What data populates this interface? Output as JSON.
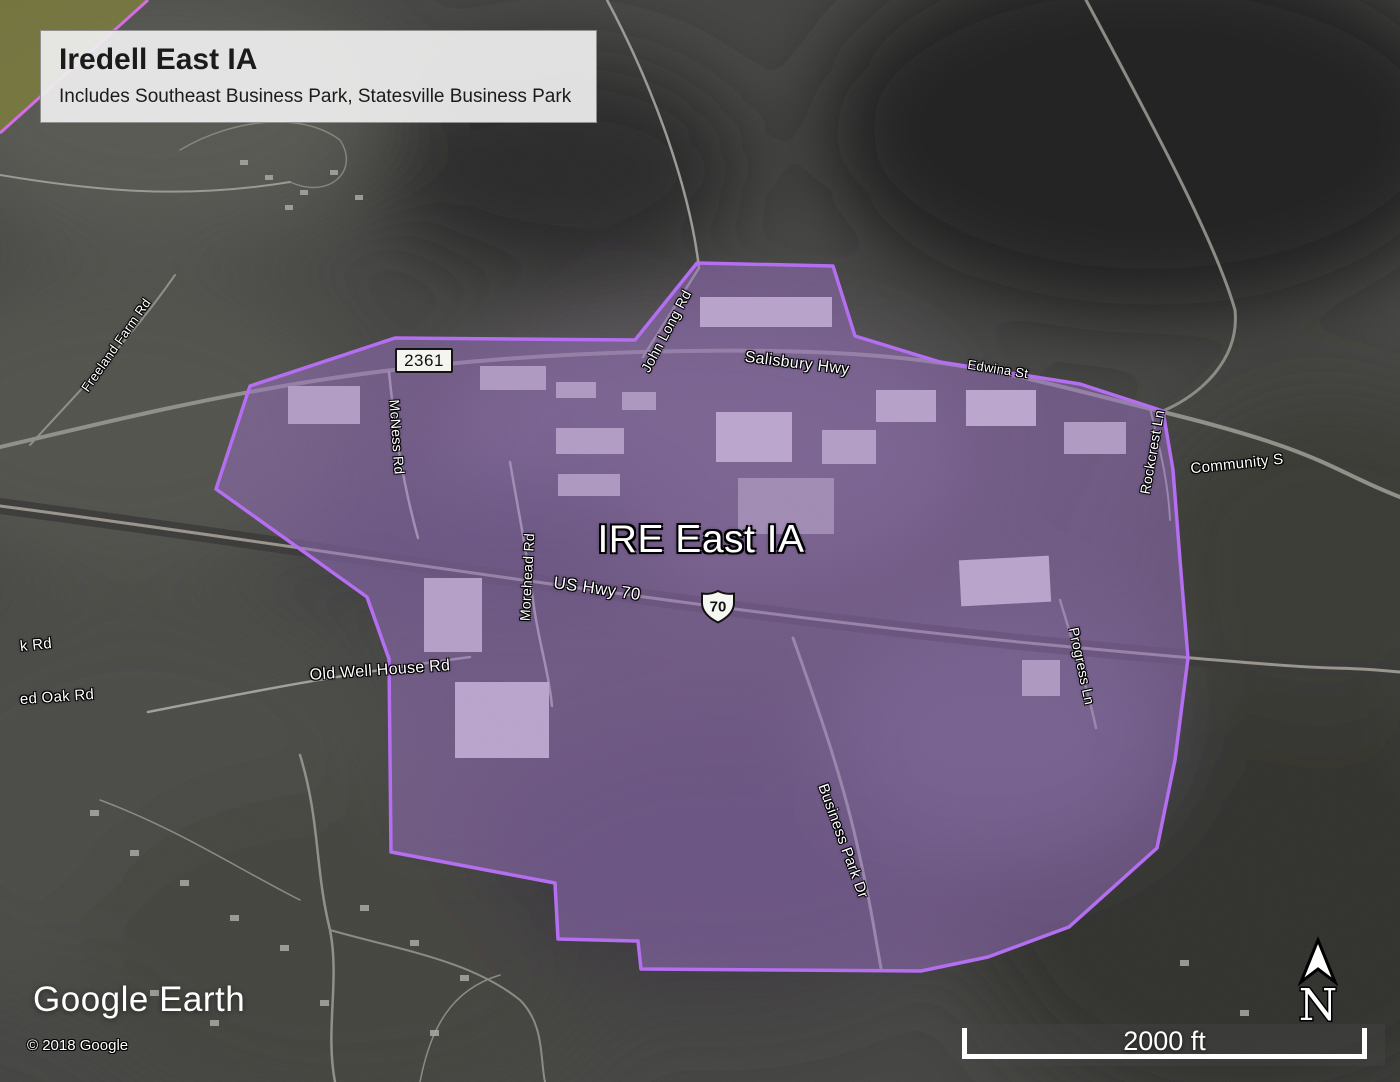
{
  "title_card": {
    "title": "Iredell East IA",
    "subtitle": "Includes Southeast Business Park, Statesville Business Park"
  },
  "area_overlay": {
    "label": "IRE East IA"
  },
  "route_shields": {
    "nc_2361": "2361",
    "us_70": "70"
  },
  "road_labels": [
    {
      "id": "salisbury-hwy",
      "text": "Salisbury Hwy",
      "x": 797,
      "y": 364,
      "rot": 7,
      "size": 16
    },
    {
      "id": "john-long-rd",
      "text": "John Long Rd",
      "x": 666,
      "y": 331,
      "rot": -62,
      "size": 14
    },
    {
      "id": "edwina-st",
      "text": "Edwina St",
      "x": 998,
      "y": 369,
      "rot": 9,
      "size": 13
    },
    {
      "id": "rockcrest-ln",
      "text": "Rockcrest Ln",
      "x": 1152,
      "y": 452,
      "rot": -80,
      "size": 14
    },
    {
      "id": "community-s",
      "text": "Community S",
      "x": 1237,
      "y": 464,
      "rot": -6,
      "size": 15
    },
    {
      "id": "mcness-rd",
      "text": "McNess Rd",
      "x": 397,
      "y": 437,
      "rot": 86,
      "size": 14
    },
    {
      "id": "morehead-rd",
      "text": "Morehead Rd",
      "x": 527,
      "y": 577,
      "rot": -87,
      "size": 14
    },
    {
      "id": "us-hwy-70",
      "text": "US Hwy 70",
      "x": 597,
      "y": 589,
      "rot": 8,
      "size": 17
    },
    {
      "id": "old-well-house-rd",
      "text": "Old Well House Rd",
      "x": 380,
      "y": 671,
      "rot": -4,
      "size": 16
    },
    {
      "id": "k-rd",
      "text": "k Rd",
      "x": 36,
      "y": 645,
      "rot": -6,
      "size": 15
    },
    {
      "id": "red-oak-rd",
      "text": "ed Oak Rd",
      "x": 57,
      "y": 697,
      "rot": -4,
      "size": 15
    },
    {
      "id": "freeland-farm-rd",
      "text": "Freeland Farm Rd",
      "x": 116,
      "y": 345,
      "rot": -55,
      "size": 13
    },
    {
      "id": "business-park-dr",
      "text": "Business Park Dr",
      "x": 843,
      "y": 841,
      "rot": 70,
      "size": 15
    },
    {
      "id": "progress-ln",
      "text": "Progress Ln",
      "x": 1082,
      "y": 666,
      "rot": 78,
      "size": 14
    }
  ],
  "attribution": {
    "logo": "Google Earth",
    "copyright": "© 2018 Google"
  },
  "scale_bar": {
    "label": "2000 ft"
  },
  "compass": {
    "letter": "N"
  },
  "colors": {
    "overlay_fill": "#9a6fc4",
    "overlay_stroke": "#b46ef0",
    "adjacent_overlay_fill": "#7c7c3f",
    "adjacent_overlay_stroke": "#d36ee4",
    "label_text": "#ffffff",
    "shield_bg": "#f4f4f0"
  }
}
